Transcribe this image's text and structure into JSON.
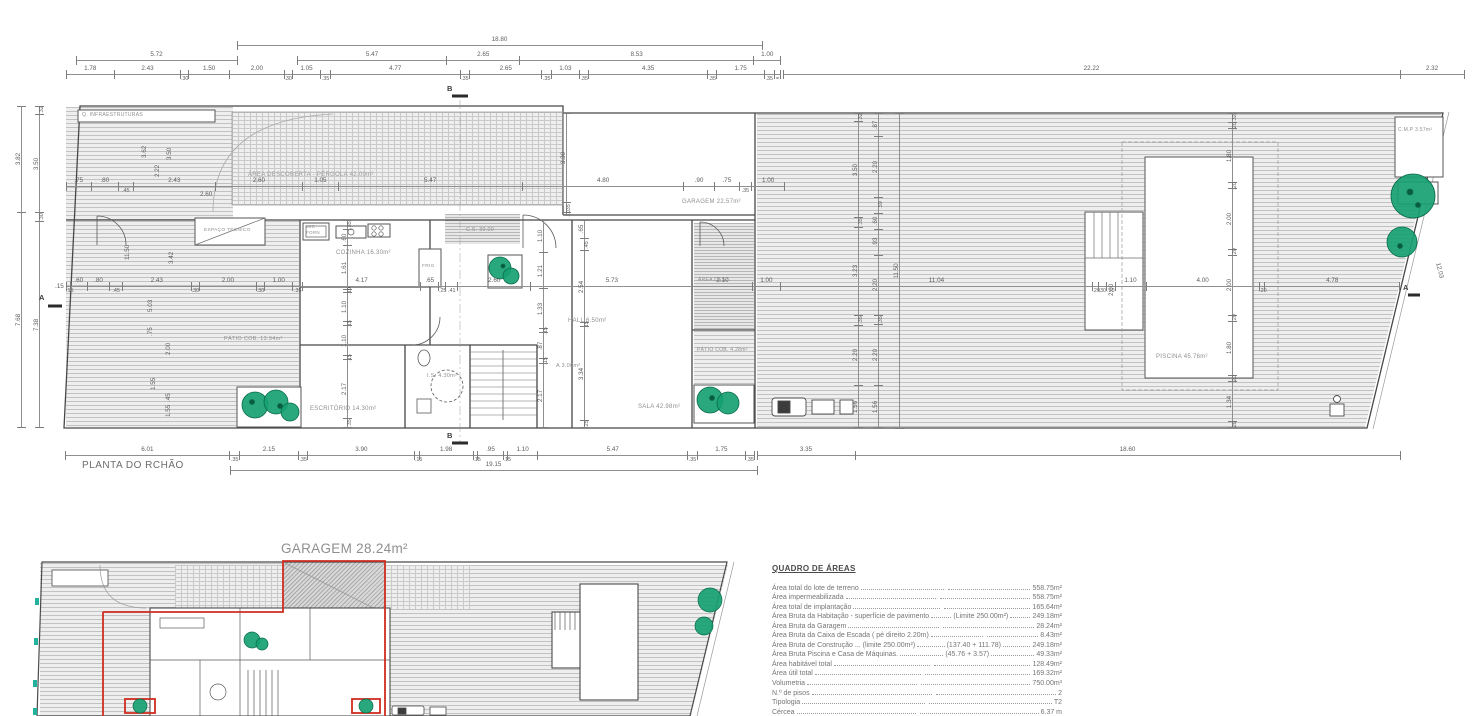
{
  "plan1": {
    "title": "PLANTA DO RCHÃO",
    "markers": {
      "a": "A",
      "b": "B"
    },
    "rooms": {
      "infra": "Q. INFRAESTRUTURAS",
      "pergola": "ÁREA DESCOBERTA - PÉRGOLA 42.00m²",
      "espaco_tecnico": "ESPAÇO TÉCNICO",
      "cozinha": "COZINHA 16.30m²",
      "mic": "MIC",
      "forn": "FORN",
      "frig": "FRIG",
      "cs": "C.S. 30.00",
      "hall": "HALL 6.50m²",
      "is": "I.S. 4.30m²",
      "arrumos": "A 3.00m²",
      "escritorio": "ESCRITÓRIO 14.30m²",
      "sala": "SALA 42.98m²",
      "patio_cob_1": "PÁTIO COB. 13.94m²",
      "patio_cob_2": "PÁTIO COB. 4.28m²",
      "garagem": "GARAGEM 22.57m²",
      "area_desc": "ÁREA DESC.",
      "piscina": "PISCINA 45.76m²",
      "cmp": "C.M.P 3.57m²"
    },
    "dims": {
      "top_main": [
        "18.80"
      ],
      "top_a": [
        "5.72"
      ],
      "top_b": [
        "5.47",
        "2.65",
        "8.53",
        "1.00"
      ],
      "top_detail": [
        "1.78",
        "2.43",
        ".30",
        "1.50",
        "2.00",
        ".30",
        "1.05",
        ".35",
        "4.77",
        ".35",
        "2.65",
        ".35",
        "1.03",
        ".35",
        "4.35",
        ".35",
        "1.75",
        ".35",
        "="
      ],
      "site_a": [
        "22.22"
      ],
      "site_b": [
        "2.32"
      ],
      "upper": [
        ".75",
        ".80",
        ".45",
        "2.43",
        "2.60",
        "1.05",
        "5.47",
        "4.80",
        ".90",
        ".75",
        ".35",
        "1.00"
      ],
      "mid": [
        ".15",
        ".60",
        ".80",
        ".45",
        "2.43",
        ".30",
        "2.00",
        ".30",
        "1.00",
        ".35",
        "4.17",
        ".65",
        ".25",
        ".41",
        "2.60",
        "5.73",
        "2.10",
        "1.00",
        "11.04",
        ".20",
        ".30",
        ".30",
        "1.10",
        "4.00",
        ".20",
        "4.78"
      ],
      "bottom_detail": [
        "6.01",
        ".35",
        "2.15",
        ".35",
        "3.90",
        ".15",
        "1.98",
        ".15",
        ".95",
        ".15",
        "1.10",
        "5.47",
        ".35",
        "1.75",
        ".35"
      ],
      "bottom_total": [
        "19.15"
      ],
      "bottom_c": [
        "3.35"
      ],
      "bottom_d": [
        "18.60"
      ],
      "left_outer": [
        "3.82",
        "7.68"
      ],
      "left_inner": [
        ".32",
        "3.50",
        ".30",
        "7.38"
      ],
      "v_kitchen": [
        ".35",
        ".60",
        "1.61",
        ".10",
        "1.10",
        ".15",
        "1.10",
        ".15",
        "2.17",
        ".35"
      ],
      "v_hall": [
        "1.10",
        "1.21",
        "1.33",
        ".15",
        ".87",
        ".15",
        "2.17"
      ],
      "v_stair": [
        ".65",
        ".45",
        "2.54",
        ".15",
        "3.34",
        ".25"
      ],
      "v_garage": [
        "3.30",
        ".35",
        ".10"
      ],
      "v_deck_a": [
        ".32",
        "3.50",
        ".35",
        "3.23",
        ".35",
        "2.20",
        "1.56"
      ],
      "v_deck_b": [
        ".87",
        "2.20",
        ".59",
        ".60",
        ".93",
        "2.20",
        ".35",
        "2.20",
        "1.56"
      ],
      "v_total": [
        "11.50"
      ],
      "v_pool": [
        ".32",
        ".20",
        "1.80",
        ".20",
        "2.00",
        ".20",
        "2.00",
        ".20",
        "1.80",
        ".20",
        "1.34",
        ".20"
      ]
    },
    "float_dims": [
      {
        "t": "3.62",
        "x": 141,
        "y": 158,
        "r": 1
      },
      {
        "t": "3.50",
        "x": 166,
        "y": 160,
        "r": 1
      },
      {
        "t": "2.22",
        "x": 154,
        "y": 177,
        "r": 1
      },
      {
        "t": "2.60",
        "x": 200,
        "y": 191
      },
      {
        "t": "11.50",
        "x": 124,
        "y": 260,
        "r": 1
      },
      {
        "t": "3.42",
        "x": 168,
        "y": 264,
        "r": 1
      },
      {
        "t": "5.03",
        "x": 147,
        "y": 312,
        "r": 1
      },
      {
        "t": ".75",
        "x": 147,
        "y": 336,
        "r": 1
      },
      {
        "t": "2.00",
        "x": 165,
        "y": 355,
        "r": 1
      },
      {
        "t": "1.55",
        "x": 150,
        "y": 390,
        "r": 1
      },
      {
        "t": ".45",
        "x": 165,
        "y": 402,
        "r": 1
      },
      {
        "t": "1.55",
        "x": 165,
        "y": 417,
        "r": 1
      },
      {
        "t": ".15",
        "x": 55,
        "y": 283
      },
      {
        "t": "12.03",
        "x": 1441,
        "y": 262,
        "d": 1
      },
      {
        "t": "2.00",
        "x": 1108,
        "y": 296,
        "r": 1
      }
    ]
  },
  "plan2": {
    "title": "GARAGEM 28.24m²"
  },
  "areas_table": {
    "title": "QUADRO DE ÁREAS",
    "rows": [
      {
        "l": "Área total do lote de terreno",
        "m": "",
        "v": "558.75m²"
      },
      {
        "l": "Área impermeabilizada",
        "m": "",
        "v": "558.75m²"
      },
      {
        "l": "Área total de implantação",
        "m": "",
        "v": "165.64m²"
      },
      {
        "l": "Área Bruta da Habitação - superfície de pavimento",
        "m": "(Limite 250.00m²)",
        "v": "249.18m²"
      },
      {
        "l": "Área Bruta da Garagem",
        "m": "",
        "v": "28.24m²"
      },
      {
        "l": "Área Bruta da Caixa de Escada ( pé direito 2.20m)",
        "m": "",
        "v": "8.43m²"
      },
      {
        "l": "Área Bruta de Construção ... (limite 250.00m²)",
        "m": "(137.40 + 111.78)",
        "v": "249.18m²"
      },
      {
        "l": "Área Bruta Piscina e Casa de Máquinas.",
        "m": "(45.76 + 3.57)",
        "v": "49.33m²"
      },
      {
        "l": "Área habitável total",
        "m": "",
        "v": "128.49m²"
      },
      {
        "l": "Área útil total",
        "m": "",
        "v": "169.32m²"
      },
      {
        "l": "Volumetria",
        "m": "",
        "v": "750.00m³"
      },
      {
        "l": "N.º de pisos",
        "m": "",
        "v": "2"
      },
      {
        "l": "Tipologia",
        "m": "",
        "v": "T2"
      },
      {
        "l": "Cércea",
        "m": "",
        "v": "6.37 m"
      }
    ]
  },
  "colors": {
    "red_outline": "#d02c20",
    "tree_green": "#16a171",
    "wall": "#474747",
    "dim_text": "#5d5d5d"
  }
}
